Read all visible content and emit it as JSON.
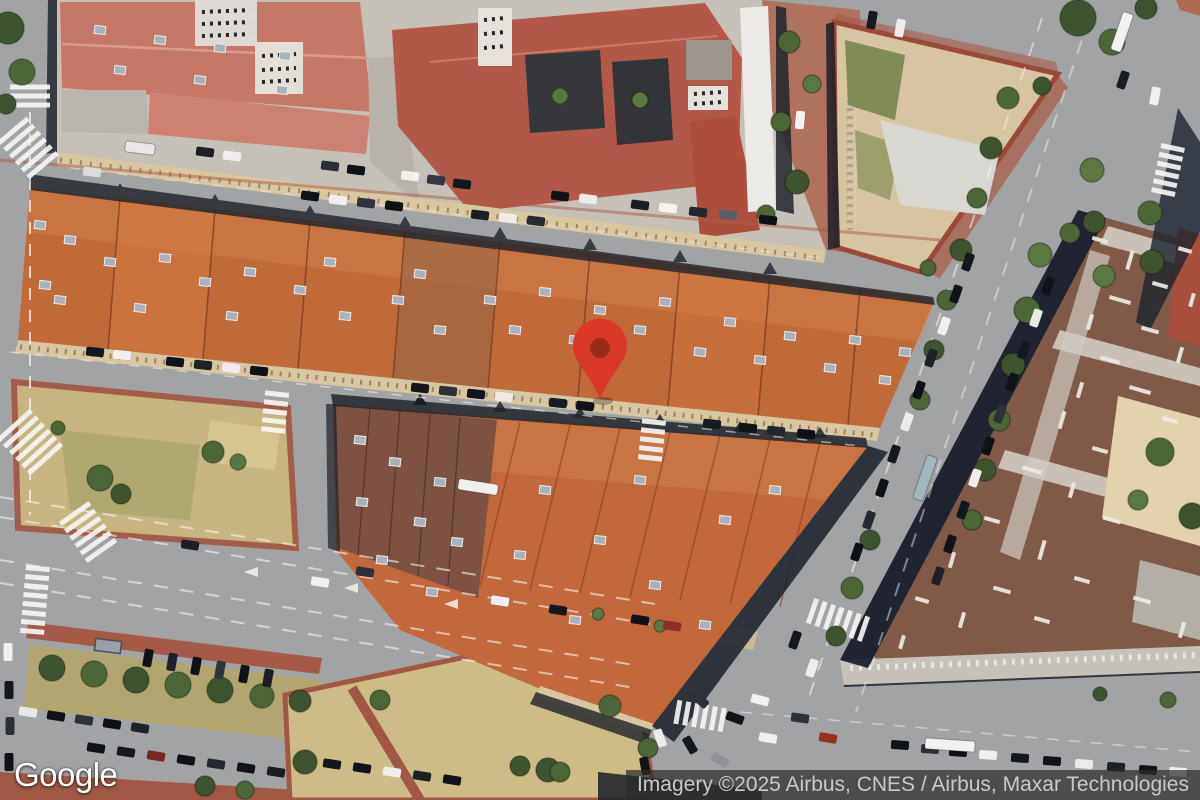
{
  "ui": {
    "logo": "Google",
    "attribution": "Imagery ©2025 Airbus, CNES / Airbus, Maxar Technologies"
  },
  "map": {
    "type": "satellite-imagery",
    "marker": {
      "color": "#DB3927",
      "inner_color": "#9A2C1B",
      "tip_x": 600,
      "tip_y": 399
    },
    "palette": {
      "road": "#a2a3a5",
      "roof_orange": "#c06a38",
      "roof_salmon": "#c57868",
      "roof_crimson": "#b25848",
      "roof_brown": "#7d5243",
      "facade_tan": "#d9c7a2",
      "park_dry": "#c8b77e",
      "shadow": "#1d212a",
      "tree_green": "#4c6637",
      "plaza_red": "#a85a46",
      "gravel_roof": "#7f5a49"
    },
    "trees": [
      [
        8,
        28,
        16,
        "#3e5430"
      ],
      [
        22,
        72,
        13,
        "#4c6637"
      ],
      [
        6,
        104,
        10,
        "#3e5430"
      ],
      [
        789,
        42,
        11,
        "#4c6637"
      ],
      [
        812,
        84,
        9,
        "#5a7842"
      ],
      [
        781,
        122,
        10,
        "#4c6637"
      ],
      [
        797,
        182,
        12,
        "#3e5430"
      ],
      [
        766,
        214,
        9,
        "#4c6637"
      ],
      [
        1042,
        86,
        9,
        "#3e5430"
      ],
      [
        928,
        268,
        8,
        "#4c6637"
      ],
      [
        1078,
        18,
        18,
        "#3e5430"
      ],
      [
        1112,
        42,
        13,
        "#4c6637"
      ],
      [
        1146,
        8,
        11,
        "#3e5430"
      ],
      [
        1092,
        170,
        12,
        "#5a7842"
      ],
      [
        1150,
        213,
        12,
        "#4c6637"
      ],
      [
        1094,
        222,
        11,
        "#3e5430"
      ],
      [
        1070,
        233,
        10,
        "#4c6637"
      ],
      [
        1152,
        262,
        12,
        "#3e5430"
      ],
      [
        1104,
        276,
        11,
        "#5a7842"
      ],
      [
        1008,
        98,
        11,
        "#4c6637"
      ],
      [
        991,
        148,
        11,
        "#3e5430"
      ],
      [
        977,
        198,
        10,
        "#4c6637"
      ],
      [
        961,
        250,
        11,
        "#3e5430"
      ],
      [
        947,
        300,
        10,
        "#4c6637"
      ],
      [
        934,
        350,
        10,
        "#3e5430"
      ],
      [
        920,
        400,
        10,
        "#4c6637"
      ],
      [
        870,
        540,
        10,
        "#3e5430"
      ],
      [
        852,
        588,
        11,
        "#4c6637"
      ],
      [
        836,
        636,
        10,
        "#3e5430"
      ],
      [
        1040,
        255,
        12,
        "#5a7842"
      ],
      [
        1027,
        310,
        13,
        "#4c6637"
      ],
      [
        1013,
        365,
        12,
        "#3e5430"
      ],
      [
        999,
        420,
        11,
        "#4c6637"
      ],
      [
        985,
        470,
        11,
        "#3e5430"
      ],
      [
        972,
        520,
        10,
        "#4c6637"
      ],
      [
        1160,
        452,
        14,
        "#4c6637"
      ],
      [
        1192,
        516,
        13,
        "#3e5430"
      ],
      [
        1138,
        500,
        10,
        "#5a7842"
      ],
      [
        100,
        478,
        13,
        "#4c6637"
      ],
      [
        121,
        494,
        10,
        "#3e5430"
      ],
      [
        213,
        452,
        11,
        "#4c6637"
      ],
      [
        238,
        462,
        8,
        "#5a7842"
      ],
      [
        58,
        428,
        7,
        "#4c6637"
      ],
      [
        52,
        668,
        13,
        "#3e5430"
      ],
      [
        94,
        674,
        13,
        "#4c6637"
      ],
      [
        136,
        680,
        13,
        "#3e5430"
      ],
      [
        178,
        685,
        13,
        "#4c6637"
      ],
      [
        220,
        690,
        13,
        "#3e5430"
      ],
      [
        262,
        696,
        12,
        "#4c6637"
      ],
      [
        300,
        701,
        11,
        "#3e5430"
      ],
      [
        380,
        700,
        10,
        "#4c6637"
      ],
      [
        305,
        762,
        12,
        "#3e5430"
      ],
      [
        610,
        706,
        11,
        "#4c6637"
      ],
      [
        548,
        770,
        12,
        "#3e5430"
      ],
      [
        648,
        748,
        10,
        "#4c6637"
      ],
      [
        205,
        786,
        10,
        "#3e5430"
      ],
      [
        245,
        790,
        9,
        "#4c6637"
      ],
      [
        520,
        766,
        10,
        "#3e5430"
      ],
      [
        560,
        772,
        10,
        "#4c6637"
      ],
      [
        598,
        614,
        6,
        "#5a7842"
      ],
      [
        660,
        626,
        6,
        "#5a7842"
      ],
      [
        1168,
        700,
        8,
        "#4c6637"
      ],
      [
        1100,
        694,
        7,
        "#3e5430"
      ],
      [
        560,
        96,
        8,
        "#5a7842"
      ],
      [
        640,
        100,
        8,
        "#5a7842"
      ]
    ],
    "cars": [
      [
        205,
        152,
        7,
        "#1c1f25"
      ],
      [
        232,
        156,
        7,
        "#f0efed"
      ],
      [
        330,
        166,
        7,
        "#2a2e36"
      ],
      [
        356,
        170,
        7,
        "#0e1116"
      ],
      [
        410,
        176,
        7,
        "#f2f1ef"
      ],
      [
        436,
        180,
        7,
        "#333842"
      ],
      [
        462,
        184,
        7,
        "#13161b"
      ],
      [
        560,
        196,
        7,
        "#101318"
      ],
      [
        588,
        199,
        7,
        "#ececea"
      ],
      [
        640,
        205,
        7,
        "#1a1d23"
      ],
      [
        668,
        208,
        7,
        "#f4f3f1"
      ],
      [
        698,
        212,
        7,
        "#23272e"
      ],
      [
        728,
        215,
        7,
        "#585d66"
      ],
      [
        768,
        220,
        7,
        "#0f1217"
      ],
      [
        92,
        172,
        7,
        "#dcdbd9"
      ],
      [
        310,
        196,
        7,
        "#0e1116"
      ],
      [
        338,
        200,
        7,
        "#f1f0ee"
      ],
      [
        366,
        203,
        7,
        "#30343d"
      ],
      [
        394,
        206,
        7,
        "#0d1014"
      ],
      [
        480,
        215,
        7,
        "#1b1f25"
      ],
      [
        508,
        218,
        7,
        "#edecea"
      ],
      [
        536,
        221,
        7,
        "#272b32"
      ],
      [
        95,
        352,
        6,
        "#15181d"
      ],
      [
        122,
        355,
        6,
        "#f2f1ef"
      ],
      [
        175,
        362,
        6,
        "#101318"
      ],
      [
        203,
        365,
        6,
        "#1e222a"
      ],
      [
        231,
        368,
        6,
        "#eeedeb"
      ],
      [
        259,
        371,
        6,
        "#0e1116"
      ],
      [
        420,
        388,
        6,
        "#14171c"
      ],
      [
        448,
        391,
        6,
        "#2c3039"
      ],
      [
        476,
        394,
        6,
        "#101318"
      ],
      [
        504,
        397,
        6,
        "#ebeae8"
      ],
      [
        558,
        403,
        6,
        "#181b21"
      ],
      [
        585,
        406,
        6,
        "#0f1216"
      ],
      [
        712,
        424,
        6,
        "#171a20"
      ],
      [
        748,
        428,
        6,
        "#101318"
      ],
      [
        776,
        431,
        6,
        "#23262d"
      ],
      [
        806,
        434,
        6,
        "#0e1115"
      ],
      [
        8,
        652,
        90,
        "#f1f0ee"
      ],
      [
        9,
        690,
        90,
        "#15181e"
      ],
      [
        10,
        726,
        90,
        "#2d313a"
      ],
      [
        9,
        762,
        90,
        "#0f1216"
      ],
      [
        190,
        545,
        9,
        "#1b1f26"
      ],
      [
        320,
        582,
        9,
        "#f0efed"
      ],
      [
        365,
        572,
        9,
        "#2b303b"
      ],
      [
        500,
        601,
        9,
        "#f1f0ee"
      ],
      [
        558,
        610,
        9,
        "#14171d"
      ],
      [
        640,
        620,
        9,
        "#101318"
      ],
      [
        672,
        626,
        9,
        "#8e2f24"
      ],
      [
        148,
        658,
        100,
        "#101318"
      ],
      [
        172,
        662,
        100,
        "#1d2129"
      ],
      [
        196,
        666,
        100,
        "#0e1116"
      ],
      [
        220,
        670,
        100,
        "#2e323b"
      ],
      [
        244,
        674,
        100,
        "#101318"
      ],
      [
        268,
        678,
        100,
        "#1a1e25"
      ],
      [
        28,
        712,
        9,
        "#e9e8e6"
      ],
      [
        56,
        716,
        9,
        "#121419"
      ],
      [
        84,
        720,
        9,
        "#2c3039"
      ],
      [
        112,
        724,
        9,
        "#0f1216"
      ],
      [
        140,
        728,
        9,
        "#1e222a"
      ],
      [
        96,
        748,
        9,
        "#101318"
      ],
      [
        126,
        752,
        9,
        "#15181e"
      ],
      [
        156,
        756,
        9,
        "#762720"
      ],
      [
        186,
        760,
        9,
        "#0e1116"
      ],
      [
        216,
        764,
        9,
        "#23272f"
      ],
      [
        246,
        768,
        9,
        "#101318"
      ],
      [
        276,
        772,
        9,
        "#191d24"
      ],
      [
        332,
        764,
        9,
        "#14171d"
      ],
      [
        362,
        768,
        9,
        "#101318"
      ],
      [
        392,
        772,
        9,
        "#edecea"
      ],
      [
        422,
        776,
        9,
        "#1b1f26"
      ],
      [
        452,
        780,
        9,
        "#0e1116"
      ],
      [
        968,
        262,
        109,
        "#14171d"
      ],
      [
        956,
        294,
        109,
        "#101318"
      ],
      [
        944,
        326,
        109,
        "#f0efed"
      ],
      [
        931,
        358,
        109,
        "#1d2129"
      ],
      [
        919,
        390,
        109,
        "#0e1116"
      ],
      [
        907,
        422,
        109,
        "#ebeae8"
      ],
      [
        894,
        454,
        109,
        "#15181e"
      ],
      [
        882,
        488,
        109,
        "#101318"
      ],
      [
        869,
        520,
        109,
        "#262a32"
      ],
      [
        857,
        552,
        109,
        "#0f1216"
      ],
      [
        1048,
        286,
        109,
        "#101318"
      ],
      [
        1036,
        318,
        109,
        "#e9e8e6"
      ],
      [
        1024,
        350,
        109,
        "#15181e"
      ],
      [
        1012,
        382,
        109,
        "#101318"
      ],
      [
        1000,
        414,
        109,
        "#2d313a"
      ],
      [
        988,
        446,
        109,
        "#0e1116"
      ],
      [
        975,
        478,
        109,
        "#f0efed"
      ],
      [
        963,
        510,
        109,
        "#14171d"
      ],
      [
        950,
        544,
        109,
        "#101318"
      ],
      [
        938,
        576,
        109,
        "#1c2028"
      ],
      [
        1123,
        80,
        109,
        "#1a1d24"
      ],
      [
        1155,
        96,
        100,
        "#f2f1ef"
      ],
      [
        872,
        20,
        100,
        "#15181e"
      ],
      [
        900,
        28,
        100,
        "#eeedeb"
      ],
      [
        700,
        700,
        40,
        "#2b303b"
      ],
      [
        735,
        718,
        20,
        "#101318"
      ],
      [
        768,
        738,
        10,
        "#f0efed"
      ],
      [
        690,
        745,
        60,
        "#15181e"
      ],
      [
        720,
        760,
        30,
        "#8f9299"
      ],
      [
        660,
        738,
        70,
        "#edecea"
      ],
      [
        645,
        766,
        80,
        "#101318"
      ],
      [
        760,
        700,
        15,
        "#f1f0ee"
      ],
      [
        800,
        718,
        8,
        "#2d323c"
      ],
      [
        828,
        738,
        10,
        "#96301f"
      ],
      [
        795,
        640,
        109,
        "#14171d"
      ],
      [
        812,
        668,
        109,
        "#eeedeb"
      ],
      [
        900,
        745,
        4,
        "#101318"
      ],
      [
        930,
        749,
        4,
        "#2c3039"
      ],
      [
        958,
        752,
        4,
        "#0e1116"
      ],
      [
        988,
        755,
        4,
        "#f0efed"
      ],
      [
        1020,
        758,
        4,
        "#15181e"
      ],
      [
        1052,
        761,
        4,
        "#101318"
      ],
      [
        1084,
        764,
        4,
        "#ecebe9"
      ],
      [
        1116,
        767,
        4,
        "#1d2129"
      ],
      [
        1148,
        770,
        4,
        "#101318"
      ],
      [
        1178,
        772,
        4,
        "#f2f1ef"
      ],
      [
        800,
        120,
        95,
        "#f4f3f1"
      ]
    ],
    "buses": [
      [
        925,
        478,
        109,
        46,
        "#a3b8be"
      ],
      [
        1122,
        32,
        109,
        40,
        "#f2f2f0"
      ],
      [
        950,
        745,
        4,
        50,
        "#f1f1ef"
      ],
      [
        478,
        487,
        9,
        40,
        "#f0efee"
      ],
      [
        140,
        148,
        7,
        30,
        "#e8e7e5"
      ]
    ],
    "skylights": [
      [
        70,
        240
      ],
      [
        110,
        262
      ],
      [
        60,
        300
      ],
      [
        140,
        308
      ],
      [
        165,
        258
      ],
      [
        205,
        282
      ],
      [
        250,
        272
      ],
      [
        232,
        316
      ],
      [
        300,
        290
      ],
      [
        330,
        262
      ],
      [
        345,
        316
      ],
      [
        398,
        300
      ],
      [
        420,
        274
      ],
      [
        440,
        330
      ],
      [
        490,
        300
      ],
      [
        515,
        330
      ],
      [
        545,
        292
      ],
      [
        575,
        340
      ],
      [
        600,
        310
      ],
      [
        640,
        330
      ],
      [
        665,
        302
      ],
      [
        700,
        352
      ],
      [
        730,
        322
      ],
      [
        760,
        360
      ],
      [
        790,
        336
      ],
      [
        830,
        368
      ],
      [
        855,
        340
      ],
      [
        885,
        380
      ],
      [
        905,
        352
      ],
      [
        40,
        225
      ],
      [
        45,
        285
      ],
      [
        545,
        490
      ],
      [
        600,
        540
      ],
      [
        655,
        585
      ],
      [
        705,
        625
      ],
      [
        575,
        620
      ],
      [
        520,
        555
      ],
      [
        725,
        520
      ],
      [
        775,
        490
      ],
      [
        640,
        480
      ],
      [
        360,
        440
      ],
      [
        395,
        462
      ],
      [
        362,
        502
      ],
      [
        420,
        522
      ],
      [
        382,
        560
      ],
      [
        440,
        482
      ],
      [
        457,
        542
      ],
      [
        432,
        592
      ],
      [
        100,
        30
      ],
      [
        160,
        40
      ],
      [
        220,
        48
      ],
      [
        285,
        56
      ],
      [
        120,
        70
      ],
      [
        200,
        80
      ],
      [
        282,
        90
      ]
    ],
    "pipes": [
      [
        1100,
        240,
        16,
        16
      ],
      [
        1130,
        260,
        20,
        106
      ],
      [
        1160,
        285,
        16,
        16
      ],
      [
        1120,
        300,
        22,
        16
      ],
      [
        1090,
        322,
        16,
        106
      ],
      [
        1150,
        330,
        18,
        16
      ],
      [
        1180,
        355,
        16,
        106
      ],
      [
        1110,
        360,
        20,
        16
      ],
      [
        1080,
        390,
        16,
        106
      ],
      [
        1140,
        390,
        22,
        16
      ],
      [
        1170,
        420,
        16,
        16
      ],
      [
        1062,
        420,
        18,
        106
      ],
      [
        1100,
        450,
        16,
        16
      ],
      [
        1032,
        470,
        20,
        16
      ],
      [
        1072,
        490,
        16,
        106
      ],
      [
        1112,
        520,
        18,
        16
      ],
      [
        992,
        520,
        16,
        16
      ],
      [
        1042,
        550,
        20,
        106
      ],
      [
        1082,
        580,
        16,
        16
      ],
      [
        952,
        560,
        16,
        106
      ],
      [
        1002,
        590,
        18,
        16
      ],
      [
        1042,
        620,
        16,
        16
      ],
      [
        962,
        620,
        16,
        106
      ],
      [
        922,
        600,
        14,
        16
      ],
      [
        902,
        642,
        14,
        106
      ],
      [
        1142,
        600,
        18,
        16
      ],
      [
        1182,
        630,
        16,
        106
      ],
      [
        1185,
        250,
        14,
        16
      ],
      [
        1192,
        300,
        14,
        106
      ]
    ],
    "zebras": [
      {
        "x": 30,
        "y": 96,
        "a": 0,
        "n": 3,
        "len": 40
      },
      {
        "x": 28,
        "y": 148,
        "a": -40,
        "n": 6,
        "len": 38
      },
      {
        "x": 30,
        "y": 442,
        "a": -42,
        "n": 6,
        "len": 44
      },
      {
        "x": 275,
        "y": 412,
        "a": 6,
        "n": 5,
        "len": 24
      },
      {
        "x": 652,
        "y": 440,
        "a": 6,
        "n": 5,
        "len": 24
      },
      {
        "x": 35,
        "y": 600,
        "a": 5,
        "n": 8,
        "len": 24
      },
      {
        "x": 88,
        "y": 532,
        "a": -35,
        "n": 6,
        "len": 36
      },
      {
        "x": 838,
        "y": 620,
        "a": 109,
        "n": 7,
        "len": 26
      },
      {
        "x": 700,
        "y": 716,
        "a": 100,
        "n": 6,
        "len": 24
      },
      {
        "x": 1168,
        "y": 170,
        "a": 12,
        "n": 6,
        "len": 24
      }
    ]
  }
}
